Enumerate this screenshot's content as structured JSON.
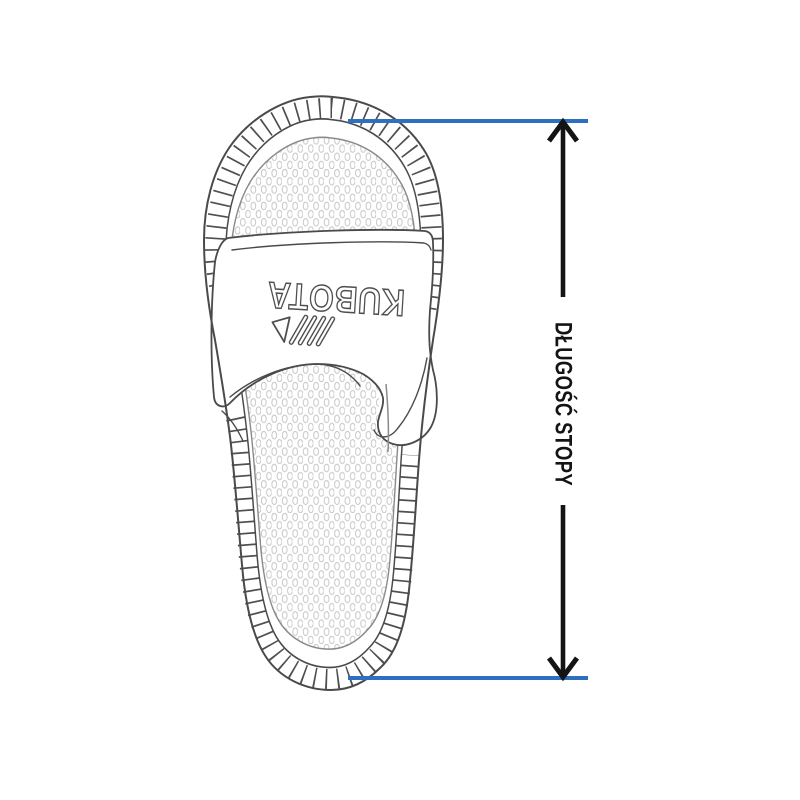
{
  "brand": {
    "name": "KUBOTA",
    "logo_icon": "three-stripes-and-triangle"
  },
  "measurement": {
    "label": "DŁUGOŚĆ STOPY",
    "arrow_direction": "vertical-double-headed",
    "from": "toe tip",
    "to": "heel tip"
  },
  "colors": {
    "measure_line_blue": "#2e6fc0",
    "arrow_black": "#141414",
    "line_gray": "#4a4a4a",
    "footbed_texture_gray": "#c3c3c3",
    "background": "#ffffff"
  }
}
